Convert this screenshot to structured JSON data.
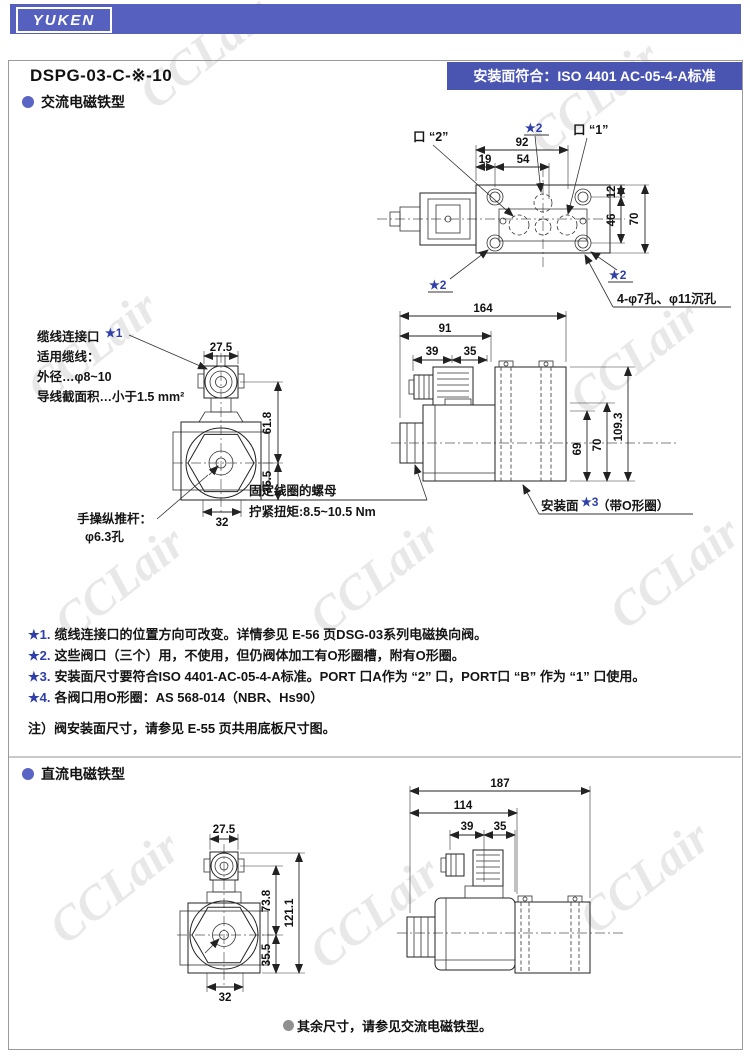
{
  "colors": {
    "banner_blue": "#5560bf",
    "label_blue": "#4a55b2",
    "star_blue": "#2f3fa8",
    "bullet_blue": "#5a64c4",
    "bullet_gray": "#909090"
  },
  "brand": {
    "logo_text": "YUKEN"
  },
  "header": {
    "model": "DSPG-03-C-※-10",
    "standard": "安装面符合：ISO 4401 AC-05-4-A标准"
  },
  "watermark": {
    "text": "CCLair"
  },
  "sections": {
    "ac_title": "交流电磁铁型",
    "dc_title": "直流电磁铁型",
    "dc_footnote": "其余尺寸，请参见交流电磁铁型。"
  },
  "top_view": {
    "dim_92": "92",
    "dim_19": "19",
    "dim_54": "54",
    "dim_12": "12",
    "dim_46": "46",
    "dim_70": "70",
    "port_2": "口 “2”",
    "port_1": "口 “1”",
    "star2": "★2",
    "holes_note": "4-φ7孔、φ11沉孔"
  },
  "front_ac": {
    "cable_title": "缆线连接口",
    "cable_star": "★1",
    "cable_line1": "适用缆线：",
    "cable_line2": "外径…φ8~10",
    "cable_line3": "导线截面积…小于1.5 mm²",
    "dim_275": "27.5",
    "dim_618": "61.8",
    "dim_355": "35.5",
    "dim_32": "32",
    "pushrod_line1": "手操纵推杆：",
    "pushrod_line2": "φ6.3孔"
  },
  "side_ac": {
    "dim_164": "164",
    "dim_91": "91",
    "dim_39": "39",
    "dim_35": "35",
    "dim_1093": "109.3",
    "dim_70": "70",
    "dim_69": "69",
    "nut_line1": "固定线圈的螺母",
    "nut_line2": "拧紧扭矩:8.5~10.5 Nm",
    "mount_pre": "安装面",
    "mount_star": "★3",
    "mount_post": "（带O形圈）"
  },
  "notes": {
    "n1_star": "★1.",
    "n1_text": "缆线连接口的位置方向可改变。详情参见 E-56 页DSG-03系列电磁换向阀。",
    "n2_star": "★2.",
    "n2_text": "这些阀口（三个）用，不使用，但仍阀体加工有O形圈槽，附有O形圈。",
    "n3_star": "★3.",
    "n3_text": "安装面尺寸要符合ISO 4401-AC-05-4-A标准。PORT 口A作为 “2” 口，PORT口 “B” 作为 “1” 口使用。",
    "n4_star": "★4.",
    "n4_text": "各阀口用O形圈：AS 568-014（NBR、Hs90）",
    "note": "注）阀安装面尺寸，请参见 E-55 页共用底板尺寸图。"
  },
  "front_dc": {
    "dim_275": "27.5",
    "dim_738": "73.8",
    "dim_1211": "121.1",
    "dim_355": "35.5",
    "dim_32": "32"
  },
  "side_dc": {
    "dim_187": "187",
    "dim_114": "114",
    "dim_39": "39",
    "dim_35": "35"
  }
}
